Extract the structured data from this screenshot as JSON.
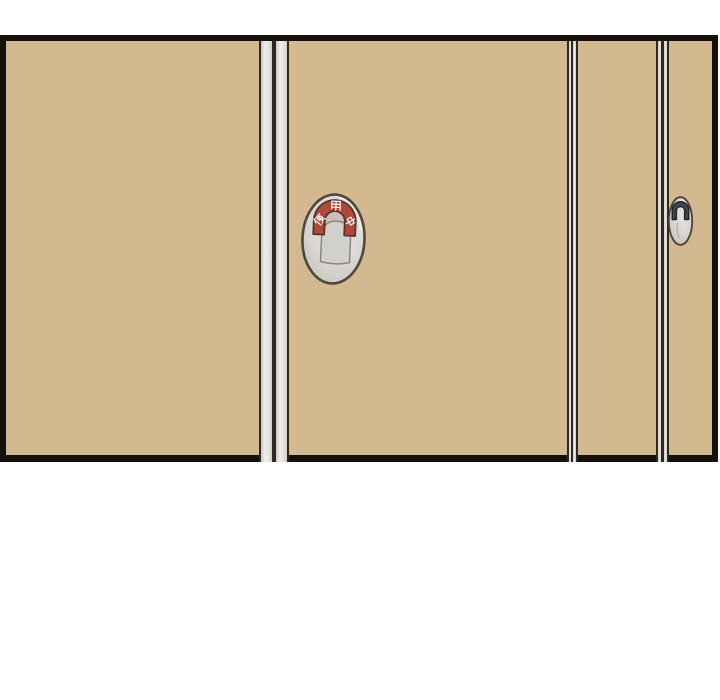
{
  "panel": {
    "frame_color": "#16110d",
    "door_color": "#d3b990",
    "divider_light_color": "#e9e6e3",
    "divider_dark_color": "#2e2823"
  },
  "occupancy_indicator": {
    "label": "使用中",
    "characters": [
      "使",
      "用",
      "中"
    ],
    "status_color": "#b2483c",
    "dial_color": "#d8d6d1",
    "knob_color": "#d2d0cb",
    "outline_color": "#50473e",
    "text_color": "#ffffff"
  },
  "edge_indicator": {
    "arch_color": "#3f434c",
    "dial_color": "#dbd8d3"
  }
}
